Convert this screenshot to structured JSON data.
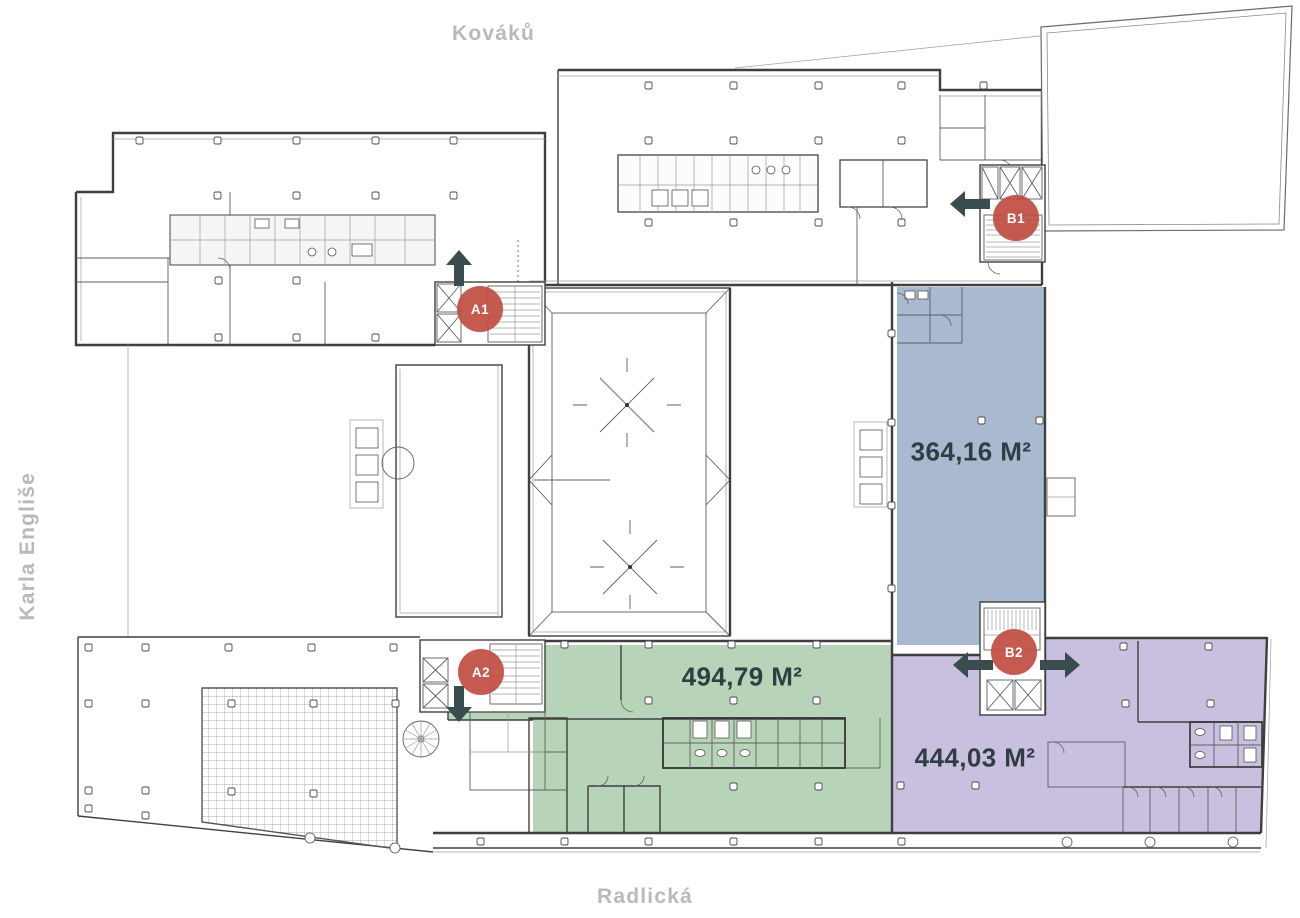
{
  "streets": {
    "top": "Kováků",
    "left": "Karla Engliše",
    "bottom": "Radlická"
  },
  "units": [
    {
      "id": "unit-blue",
      "area_label": "364,16 M²",
      "color": "#a8b9d0"
    },
    {
      "id": "unit-green",
      "area_label": "494,79 M²",
      "color": "#b7d4b8"
    },
    {
      "id": "unit-purple",
      "area_label": "444,03 M²",
      "color": "#c9c0df"
    }
  ],
  "markers": [
    {
      "id": "A1",
      "label": "A1",
      "direction": "up"
    },
    {
      "id": "B1",
      "label": "B1",
      "direction": "left"
    },
    {
      "id": "A2",
      "label": "A2",
      "direction": "down"
    },
    {
      "id": "B2",
      "label": "B2",
      "direction": "left-right"
    }
  ],
  "colors": {
    "marker_red": "#c14f43",
    "arrow_dark": "#3a4d4e",
    "area_text": "#2f3e42",
    "street_text": "#b9b9b9",
    "plan_line": "#3f3f3f"
  }
}
